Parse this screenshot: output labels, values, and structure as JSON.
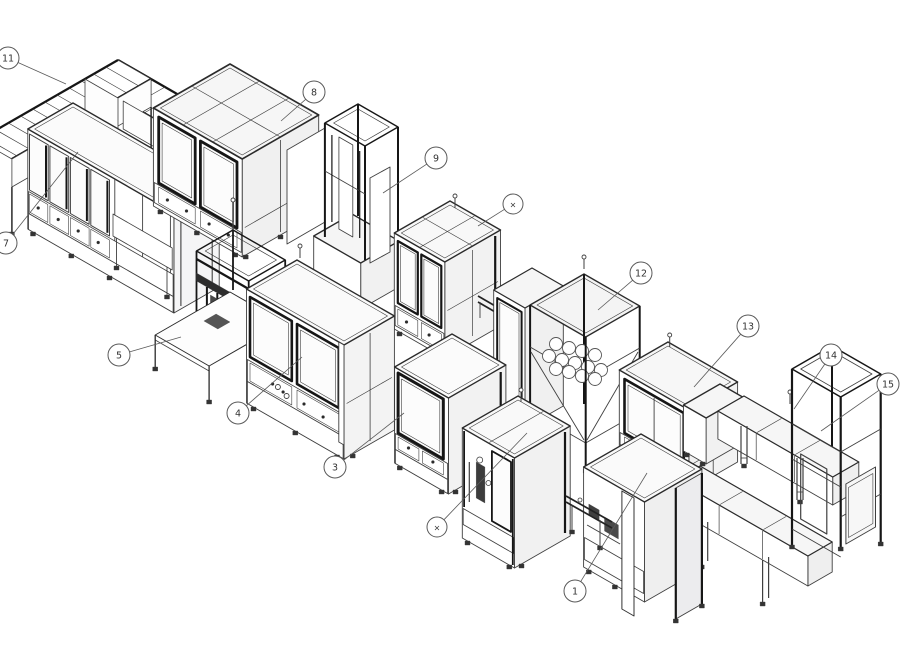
{
  "diagram": {
    "background": "#ffffff",
    "colors": {
      "stroke": "#3f3f3f",
      "edge": "#2b2b2b",
      "dark": "#161616",
      "panel": "#f1f1f1",
      "glass": "#fcfcfc",
      "light": "#f6f6f6",
      "leader": "#5a5a5a",
      "balloon_stroke": "#5a5a5a",
      "balloon_text": "#333333"
    },
    "callouts": [
      {
        "id": "c11",
        "label": "11",
        "cx": 8,
        "cy": 58,
        "ex": 66,
        "ey": 84
      },
      {
        "id": "c7",
        "label": "7",
        "cx": 6,
        "cy": 243,
        "ex": 78,
        "ey": 152
      },
      {
        "id": "c8",
        "label": "8",
        "cx": 314,
        "cy": 92,
        "ex": 281,
        "ey": 121
      },
      {
        "id": "c9",
        "label": "9",
        "cx": 436,
        "cy": 158,
        "ex": 383,
        "ey": 193
      },
      {
        "id": "cx1",
        "label": "×",
        "cx": 513,
        "cy": 204,
        "ex": 478,
        "ey": 226
      },
      {
        "id": "c12",
        "label": "12",
        "cx": 641,
        "cy": 273,
        "ex": 598,
        "ey": 310
      },
      {
        "id": "c13",
        "label": "13",
        "cx": 748,
        "cy": 326,
        "ex": 694,
        "ey": 387
      },
      {
        "id": "c14",
        "label": "14",
        "cx": 831,
        "cy": 355,
        "ex": 794,
        "ey": 409
      },
      {
        "id": "c15",
        "label": "15",
        "cx": 888,
        "cy": 384,
        "ex": 821,
        "ey": 431
      },
      {
        "id": "c5",
        "label": "5",
        "cx": 119,
        "cy": 355,
        "ex": 181,
        "ey": 337
      },
      {
        "id": "c4",
        "label": "4",
        "cx": 238,
        "cy": 413,
        "ex": 302,
        "ey": 357
      },
      {
        "id": "c3",
        "label": "3",
        "cx": 335,
        "cy": 467,
        "ex": 404,
        "ey": 413
      },
      {
        "id": "cx2",
        "label": "×",
        "cx": 437,
        "cy": 527,
        "ex": 527,
        "ey": 433
      },
      {
        "id": "c1",
        "label": "1",
        "cx": 575,
        "cy": 591,
        "ex": 647,
        "ey": 473
      }
    ],
    "modules": [
      {
        "name": "module-11-corner-conveyor"
      },
      {
        "name": "module-7-cabinet"
      },
      {
        "name": "module-8-cabinet"
      },
      {
        "name": "module-9-tower"
      },
      {
        "name": "module-x-top-cell"
      },
      {
        "name": "module-12-reel-rack"
      },
      {
        "name": "module-13-cabinet"
      },
      {
        "name": "module-14-bridge"
      },
      {
        "name": "module-15-gantry"
      },
      {
        "name": "module-5-station"
      },
      {
        "name": "module-4-cabinet"
      },
      {
        "name": "module-3-cabinet"
      },
      {
        "name": "module-x-bottom-cell"
      },
      {
        "name": "module-1-machine"
      }
    ]
  }
}
